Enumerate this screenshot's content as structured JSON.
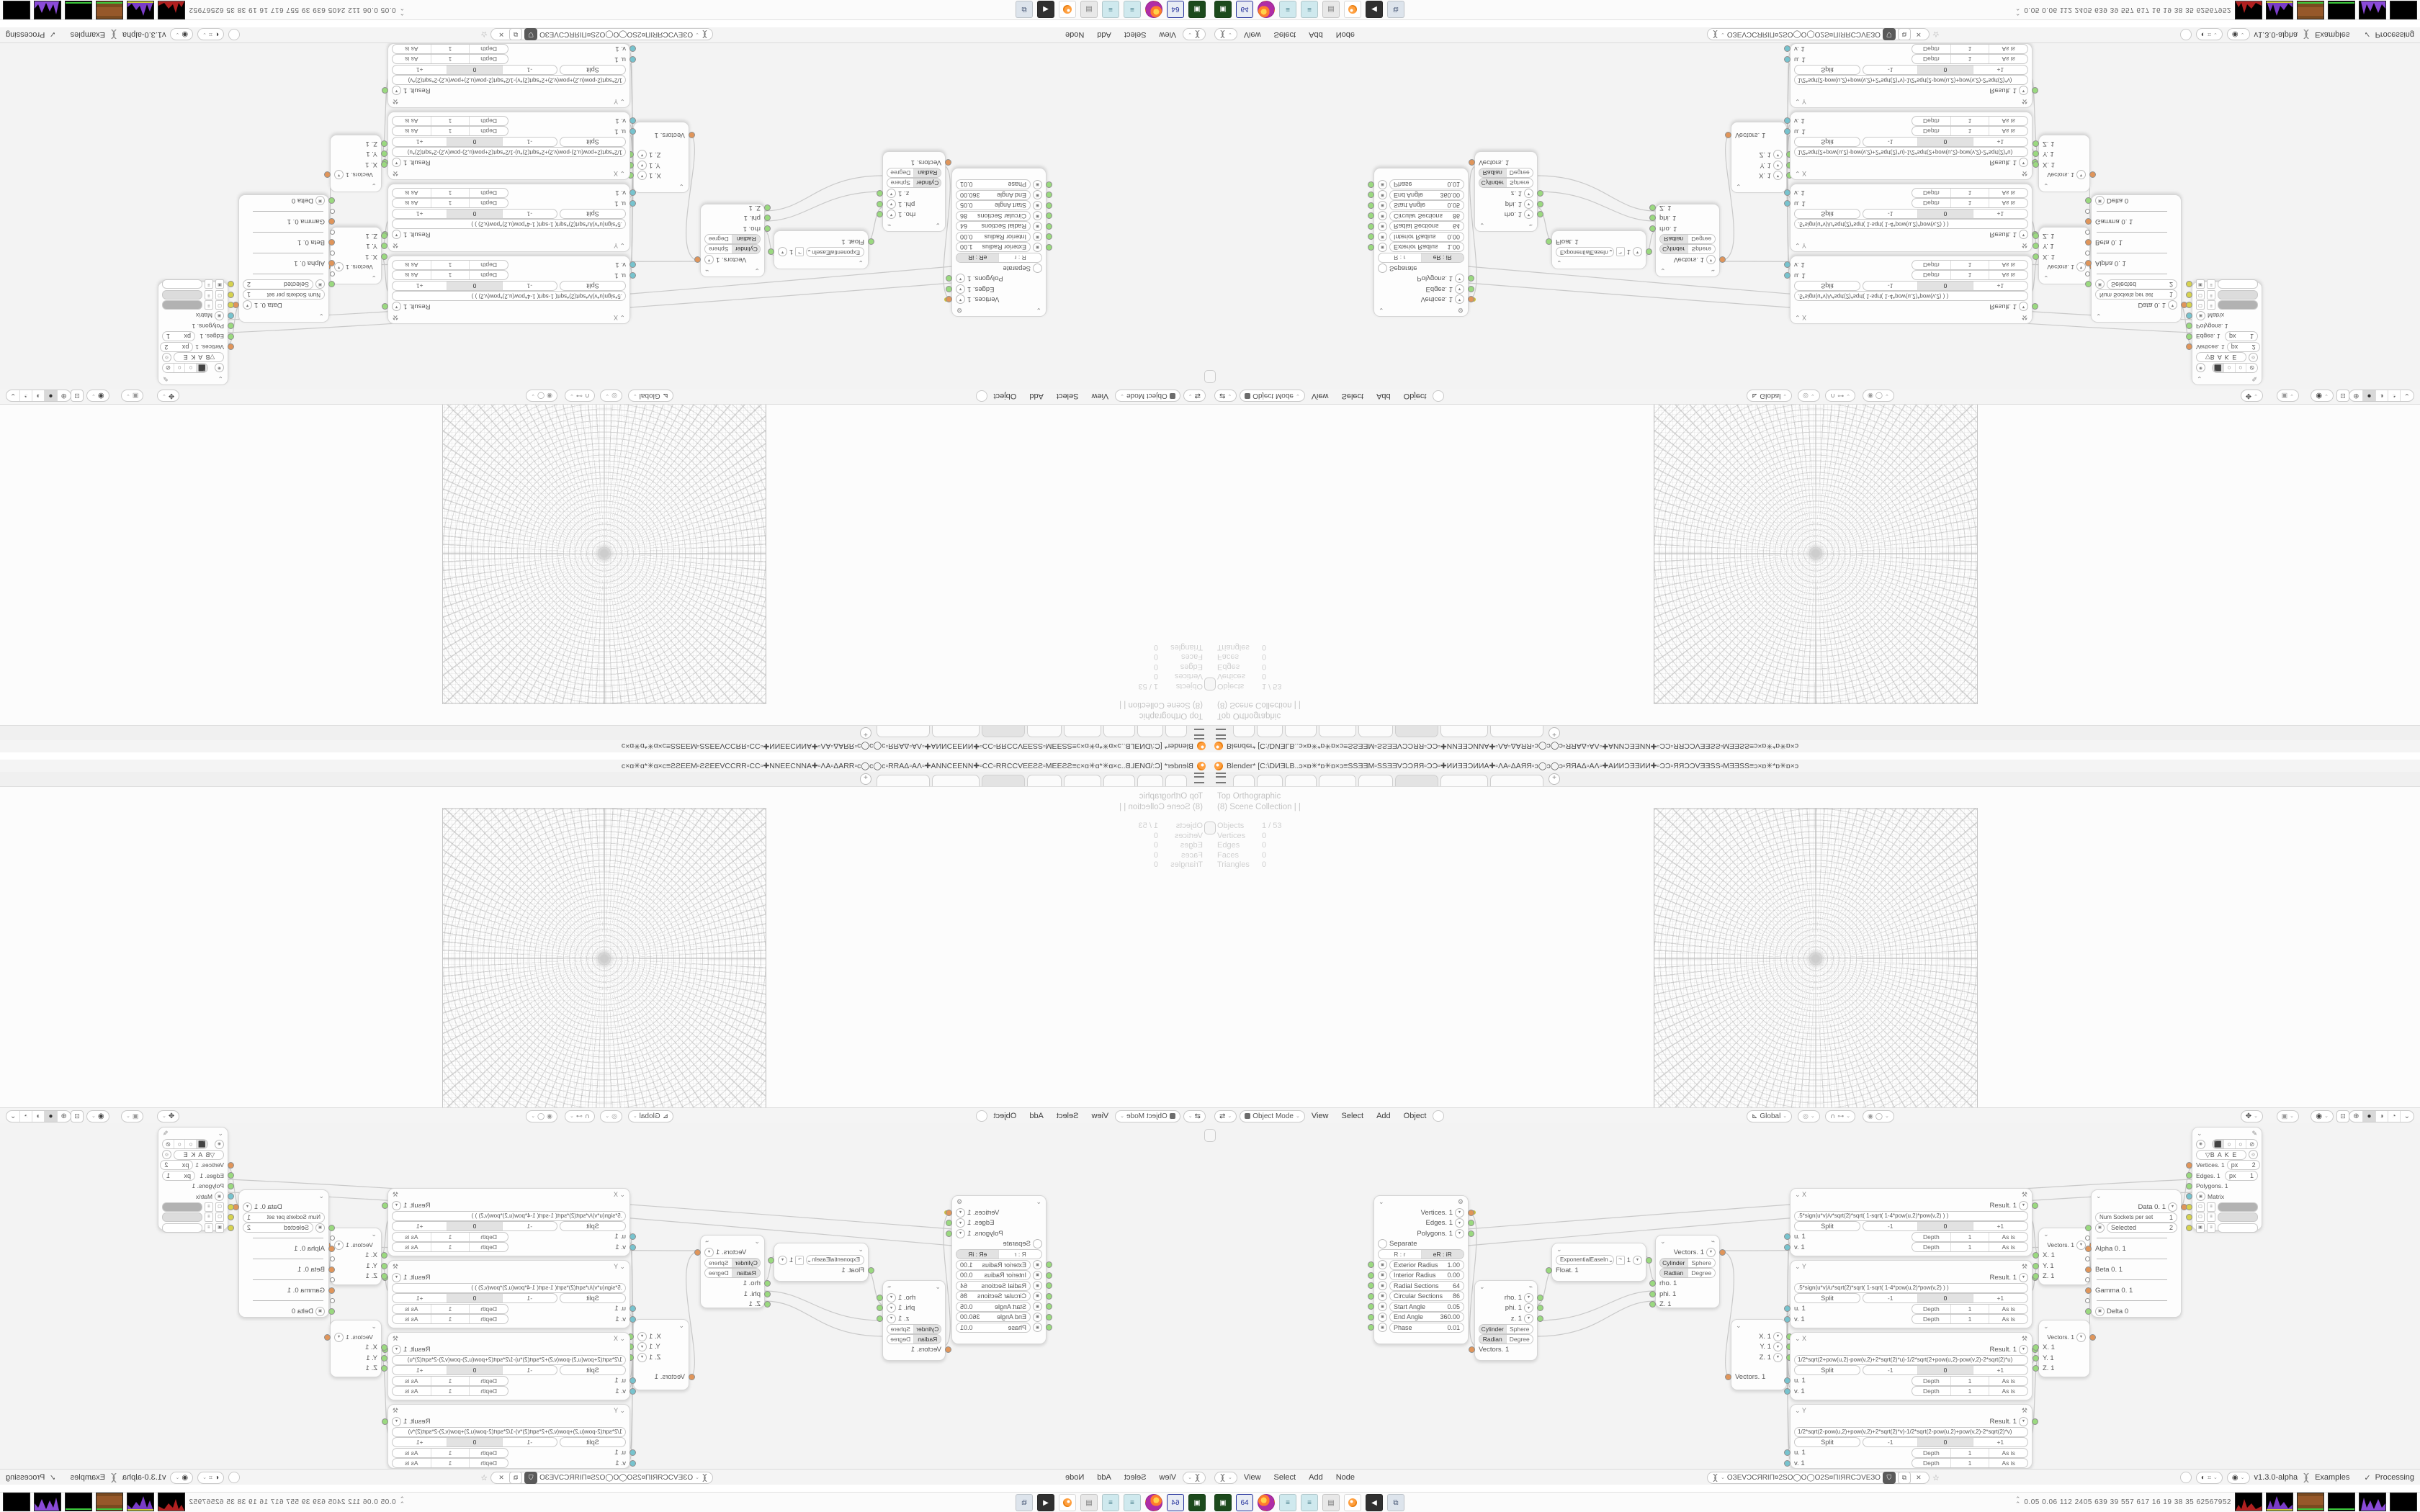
{
  "window": {
    "title": "Blender* [C:\\DИƎLB..ɔ×ɒ✳*ɒ✳ɒ×ɔ≡SSƎƎM▫SSƎƎVϽϽЯЯ▫ϽϽ▫✚ИИƎƎϽИИA✚▫ΛA▫ΔAЯЯ▫ɔ◯ɔ◯ɔ▫ЯЯAΔ▫AΛ▫✚AИИϽƎƎИИ✚▫ϽϽ▫ЯЯϽϽVƎƎSS▫MƎƎSS≡ɔ×ɒ✳*ɒ✳ɒ×ɔ",
    "tab_add": "+"
  },
  "viewport": {
    "view_label": "Top Orthographic",
    "collection": "(8) Scene Collection | |",
    "stats": {
      "objects_label": "Objects",
      "objects": "1 / 53",
      "vertices_label": "Vertices",
      "vertices": "0",
      "edges_label": "Edges",
      "edges": "0",
      "faces_label": "Faces",
      "faces": "0",
      "triangles_label": "Triangles",
      "triangles": "0"
    },
    "header": {
      "mode": "Object Mode",
      "view": "View",
      "select": "Select",
      "add": "Add",
      "object": "Object",
      "orientation": "Global"
    }
  },
  "editor": {
    "header": {
      "view": "View",
      "select": "Select",
      "add": "Add",
      "node": "Node",
      "tree_name": "ОЗЕVϽСЯRIΠ¤2SO◯O◯O2S¤ΠIЯRСϽVЕЗО",
      "version": "v1.3.0-alpha",
      "examples": "Examples",
      "processing": "Processing"
    }
  },
  "nodes": {
    "torus": {
      "out_vertices": "Vertices. 1",
      "out_edges": "Edges. 1",
      "out_polygons": "Polygons. 1",
      "separate": "Separate",
      "mode_a": "R : r",
      "mode_b": "eR : iR",
      "p1l": "Exterior Radius",
      "p1v": "1.00",
      "p2l": "Interior Radius",
      "p2v": "0.00",
      "p3l": "Radial Sections",
      "p3v": "64",
      "p4l": "Circular Sections",
      "p4v": "86",
      "p5l": "Start Angle",
      "p5v": "0.05",
      "p6l": "End Angle",
      "p6v": "360.00",
      "p7l": "Phase",
      "p7v": "0.01"
    },
    "polar_out": {
      "rho": "rho. 1",
      "phi": "phi. 1",
      "z": "z. 1",
      "cylinder": "Cylinder",
      "sphere": "Sphere",
      "radian": "Radian",
      "degree": "Degree",
      "vectors": "Vectors. 1"
    },
    "easing": {
      "mode": "ExponentialEaseIn",
      "value": "1",
      "float": "Float. 1"
    },
    "polar_in": {
      "vectors": "Vectors. 1",
      "cylinder": "Cylinder",
      "sphere": "Sphere",
      "radian": "Radian",
      "degree": "Degree",
      "rho": "rho. 1",
      "phi": "phi. 1",
      "z": "Z. 1"
    },
    "vec_out": {
      "x": "X. 1",
      "y": "Y. 1",
      "z": "Z. 1",
      "vectors": "Vectors. 1"
    },
    "formula_common": {
      "result": "Result. 1",
      "split": "Split",
      "minus": "-1",
      "zero": "0",
      "plus": "+1",
      "u": "u. 1",
      "v": "v. 1",
      "depth": "Depth",
      "depth_value": "1",
      "as_is": "As is"
    },
    "formulas": {
      "t1": "X",
      "t2": "Y",
      "t3": "X",
      "t4": "Y",
      "f1": ".5*sign(u*v)/v*sqrt(2)*sqrt(   1-sqrt(   1-4*pow(u,2)*pow(v,2)   )   )",
      "f2": ".5*sign(u*v)/u*sqrt(2)*sqrt(   1-sqrt(   1-4*pow(u,2)*pow(v,2)   )   )",
      "f3": "1/2*sqrt(2+pow(u,2)-pow(v,2)+2*sqrt(2)*u)-1/2*sqrt(2+pow(u,2)-pow(v,2)-2*sqrt(2)*u)",
      "f4": "1/2*sqrt(2-pow(u,2)+pow(v,2)+2*sqrt(2)*v)-1/2*sqrt(2-pow(u,2)+pow(v,2)-2*sqrt(2)*v)"
    },
    "vec_in": {
      "vectors": "Vectors. 1",
      "x": "X. 1",
      "y": "Y. 1",
      "z": "Z. 1"
    },
    "selected": {
      "out": "Data 0. 1",
      "num_label": "Num Sockets per set",
      "num_value": "1",
      "sel_label": "Selected",
      "sel_value": "2",
      "alpha": "Alpha 0. 1",
      "beta": "Beta 0. 1",
      "gamma": "Gamma 0. 1",
      "delta": "Delta 0"
    },
    "viewer": {
      "bake": "B A K E",
      "vertices": "Vertices. 1",
      "px1_label": "px",
      "px1": "2",
      "edges": "Edges. 1",
      "px2_label": "px",
      "px2": "1",
      "polygons": "Polygons. 1",
      "matrix": "Matrix"
    }
  },
  "taskbar": {
    "monitor": "0.05 0.06 112 2405 639   39   557   617   16   19   38   35   62567952"
  }
}
